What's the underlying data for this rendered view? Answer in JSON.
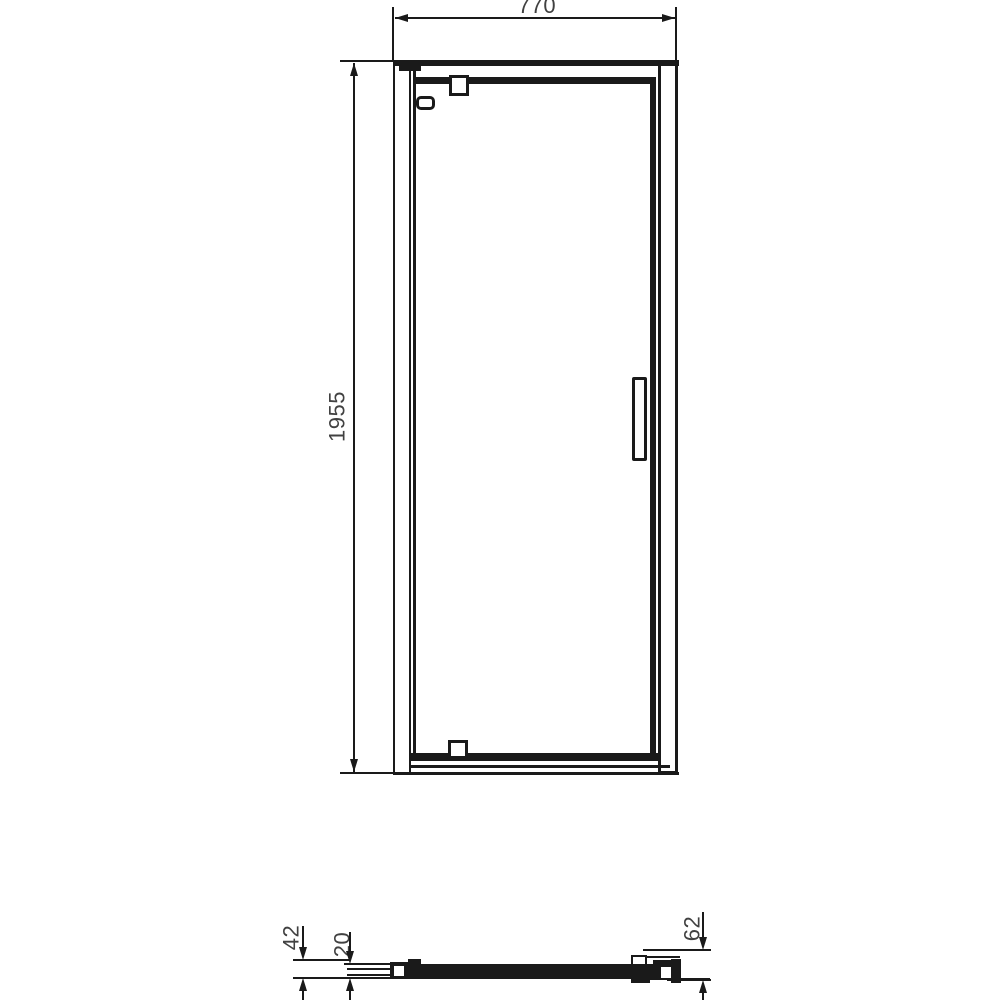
{
  "dims": {
    "overall_width": "770",
    "overall_height": "1955",
    "bottom_profile_height": "42",
    "glass_inset": "20",
    "wall_profile_height": "62"
  },
  "colors": {
    "line": "#1a1a1a",
    "text": "#414141",
    "background": "#ffffff"
  }
}
